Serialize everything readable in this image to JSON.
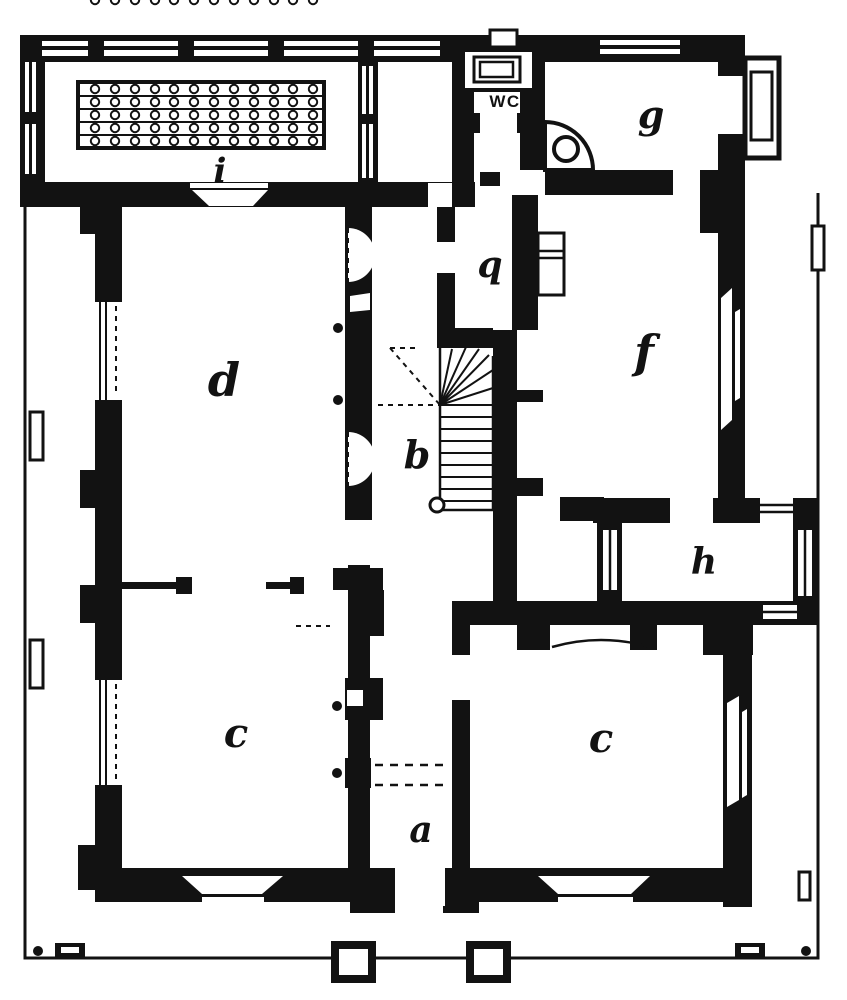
{
  "figure": {
    "kind": "scanned ground-floor plan engraving",
    "style": "black ink on white paper"
  },
  "colors": {
    "ink": "#121212",
    "paper": "#ffffff"
  },
  "rooms": {
    "veranda": {
      "label": "i"
    },
    "wc": {
      "label": "WC"
    },
    "g": {
      "label": "g"
    },
    "q": {
      "label": "q"
    },
    "d": {
      "label": "d"
    },
    "stairs": {
      "label": "b"
    },
    "f": {
      "label": "f"
    },
    "h": {
      "label": "h"
    },
    "c_left": {
      "label": "c"
    },
    "c_right": {
      "label": "c"
    },
    "a": {
      "label": "a"
    }
  },
  "fixtures": {
    "plant_stand": {
      "rows": 5,
      "columns": 12
    },
    "stair": {
      "straight_treads": 9,
      "winders": 6
    },
    "corner_stoves": 2,
    "bay_windows": 2,
    "porch_pillars": 2
  }
}
